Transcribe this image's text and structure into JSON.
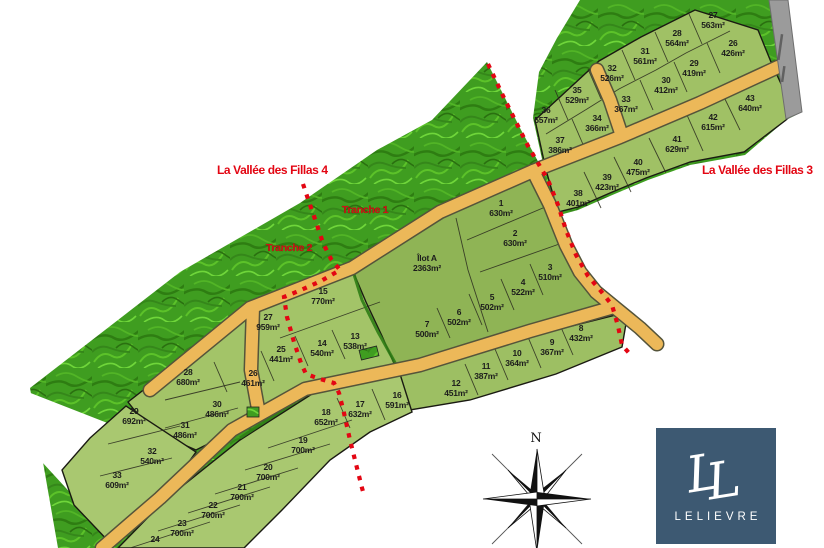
{
  "region_labels": {
    "fillas4": "La Vallée des Fillas 4",
    "fillas3": "La Vallée des Fillas 3",
    "tranche1": "Tranche 1",
    "tranche2": "Tranche 2"
  },
  "compass": {
    "north": "N"
  },
  "logo": {
    "brand": "LELIEVRE",
    "monogram": "LL"
  },
  "colors": {
    "boundary_red": "#e30613",
    "road_orange": "#ecb859",
    "grass_green": "#3f9d20",
    "lot_green": "#9fc164",
    "logo_blue": "#3d5972",
    "gray_road": "#9b9b9b"
  },
  "clusters": [
    {
      "id": "fillas3",
      "lots": [
        {
          "n": "27",
          "area": "563m²",
          "x": 713,
          "y": 20
        },
        {
          "n": "28",
          "area": "564m²",
          "x": 677,
          "y": 38
        },
        {
          "n": "26",
          "area": "426m²",
          "x": 733,
          "y": 48
        },
        {
          "n": "31",
          "area": "561m²",
          "x": 645,
          "y": 56
        },
        {
          "n": "29",
          "area": "419m²",
          "x": 694,
          "y": 68
        },
        {
          "n": "32",
          "area": "526m²",
          "x": 612,
          "y": 73
        },
        {
          "n": "30",
          "area": "412m²",
          "x": 666,
          "y": 85
        },
        {
          "n": "35",
          "area": "529m²",
          "x": 577,
          "y": 95
        },
        {
          "n": "33",
          "area": "367m²",
          "x": 626,
          "y": 104
        },
        {
          "n": "43",
          "area": "640m²",
          "x": 750,
          "y": 103
        },
        {
          "n": "36",
          "area": "557m²",
          "x": 546,
          "y": 115
        },
        {
          "n": "34",
          "area": "366m²",
          "x": 597,
          "y": 123
        },
        {
          "n": "42",
          "area": "615m²",
          "x": 713,
          "y": 122
        },
        {
          "n": "37",
          "area": "386m²",
          "x": 560,
          "y": 145
        },
        {
          "n": "41",
          "area": "629m²",
          "x": 677,
          "y": 144
        },
        {
          "n": "40",
          "area": "475m²",
          "x": 638,
          "y": 167
        },
        {
          "n": "39",
          "area": "423m²",
          "x": 607,
          "y": 182
        },
        {
          "n": "38",
          "area": "401m²",
          "x": 578,
          "y": 198
        }
      ]
    },
    {
      "id": "centre",
      "lots": [
        {
          "n": "1",
          "area": "630m²",
          "x": 501,
          "y": 208
        },
        {
          "n": "2",
          "area": "630m²",
          "x": 515,
          "y": 238
        },
        {
          "n": "Îlot A",
          "area": "2363m²",
          "x": 427,
          "y": 263
        },
        {
          "n": "3",
          "area": "510m²",
          "x": 550,
          "y": 272
        },
        {
          "n": "4",
          "area": "522m²",
          "x": 523,
          "y": 287
        },
        {
          "n": "5",
          "area": "502m²",
          "x": 492,
          "y": 302
        },
        {
          "n": "6",
          "area": "502m²",
          "x": 459,
          "y": 317
        },
        {
          "n": "7",
          "area": "500m²",
          "x": 427,
          "y": 329
        },
        {
          "n": "8",
          "area": "432m²",
          "x": 581,
          "y": 333
        },
        {
          "n": "9",
          "area": "367m²",
          "x": 552,
          "y": 347
        },
        {
          "n": "10",
          "area": "364m²",
          "x": 517,
          "y": 358
        },
        {
          "n": "11",
          "area": "387m²",
          "x": 486,
          "y": 371
        },
        {
          "n": "12",
          "area": "451m²",
          "x": 456,
          "y": 388
        }
      ]
    },
    {
      "id": "ouest",
      "lots": [
        {
          "n": "15",
          "area": "770m²",
          "x": 323,
          "y": 296
        },
        {
          "n": "27",
          "area": "959m²",
          "x": 268,
          "y": 322
        },
        {
          "n": "13",
          "area": "538m²",
          "x": 355,
          "y": 341
        },
        {
          "n": "14",
          "area": "540m²",
          "x": 322,
          "y": 348
        },
        {
          "n": "25",
          "area": "441m²",
          "x": 281,
          "y": 354
        },
        {
          "n": "26",
          "area": "461m²",
          "x": 253,
          "y": 378
        },
        {
          "n": "28",
          "area": "680m²",
          "x": 188,
          "y": 377
        },
        {
          "n": "30",
          "area": "486m²",
          "x": 217,
          "y": 409
        },
        {
          "n": "29",
          "area": "692m²",
          "x": 134,
          "y": 416
        },
        {
          "n": "31",
          "area": "486m²",
          "x": 185,
          "y": 430
        },
        {
          "n": "32",
          "area": "540m²",
          "x": 152,
          "y": 456
        },
        {
          "n": "33",
          "area": "609m²",
          "x": 117,
          "y": 480
        }
      ]
    },
    {
      "id": "sud",
      "lots": [
        {
          "n": "16",
          "area": "591m²",
          "x": 397,
          "y": 400
        },
        {
          "n": "17",
          "area": "632m²",
          "x": 360,
          "y": 409
        },
        {
          "n": "18",
          "area": "652m²",
          "x": 326,
          "y": 417
        },
        {
          "n": "19",
          "area": "700m²",
          "x": 303,
          "y": 445
        },
        {
          "n": "20",
          "area": "700m²",
          "x": 268,
          "y": 472
        },
        {
          "n": "21",
          "area": "700m²",
          "x": 242,
          "y": 492
        },
        {
          "n": "22",
          "area": "700m²",
          "x": 213,
          "y": 510
        },
        {
          "n": "23",
          "area": "700m²",
          "x": 182,
          "y": 528
        },
        {
          "n": "24",
          "area": "",
          "x": 155,
          "y": 544
        }
      ]
    }
  ]
}
